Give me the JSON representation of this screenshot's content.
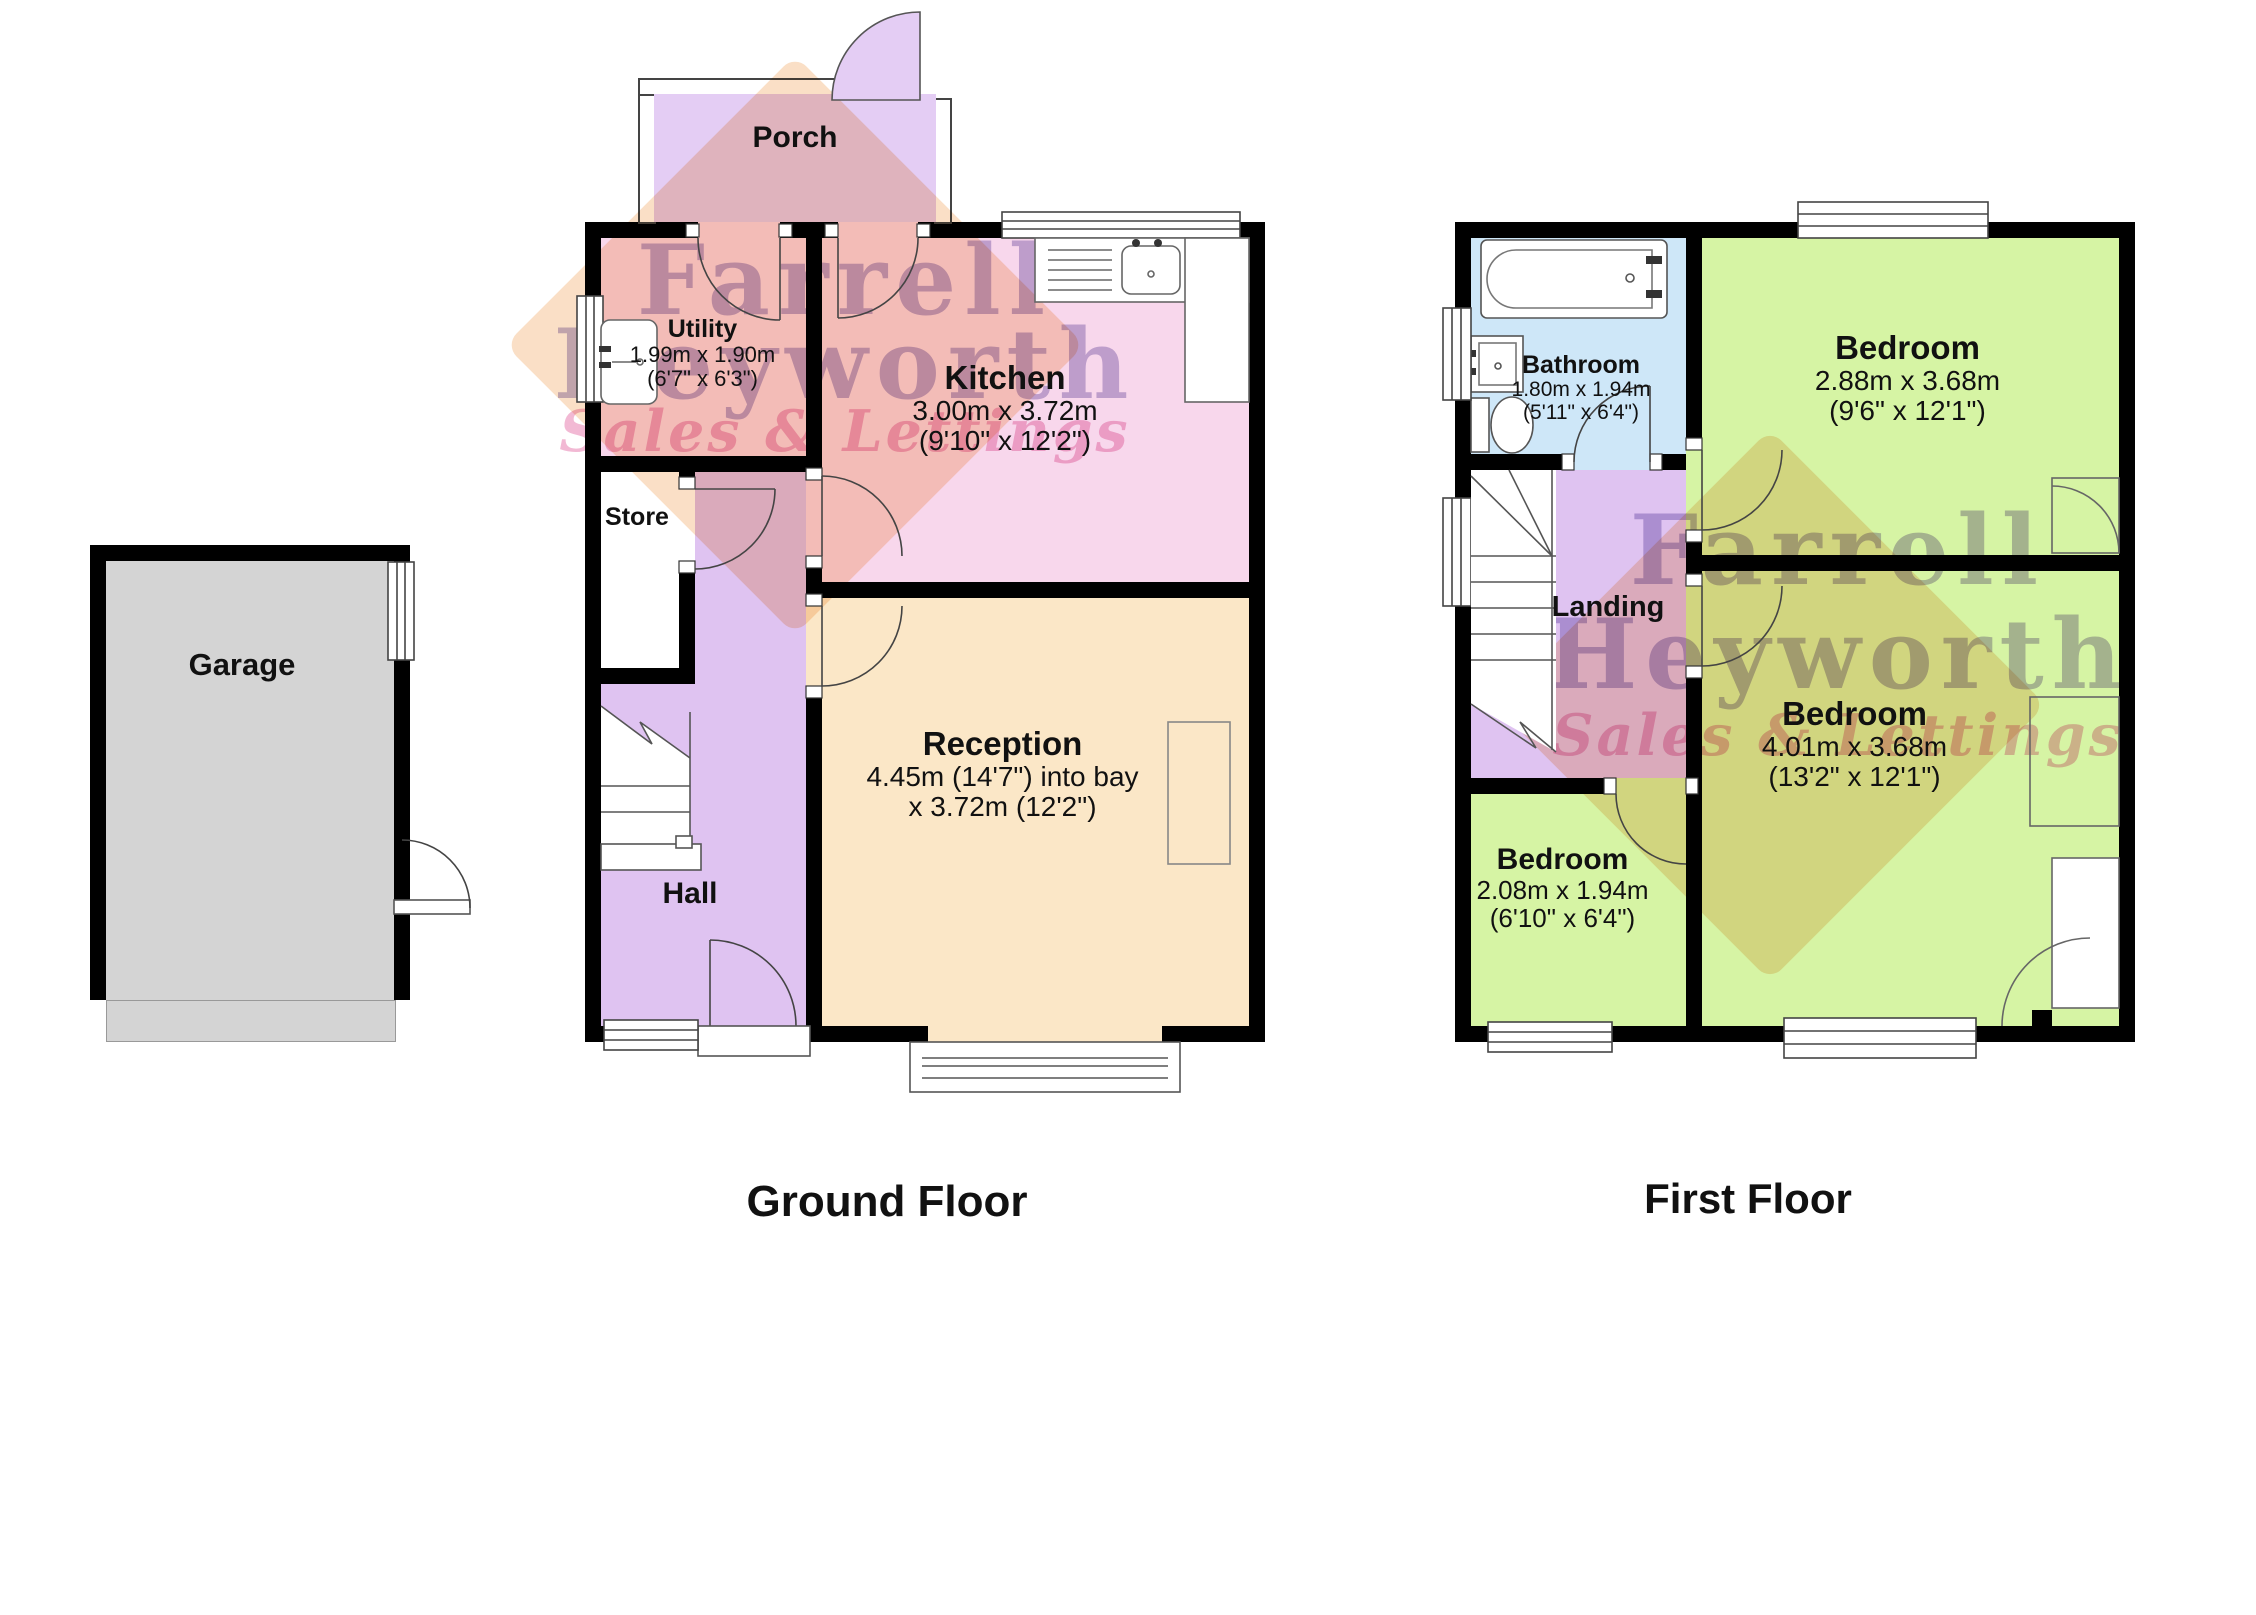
{
  "watermark": {
    "line1": "Farrell",
    "line2": "Heyworth",
    "line3": "Sales & Lettings"
  },
  "ground_floor": {
    "title": "Ground Floor",
    "porch": {
      "name": "Porch"
    },
    "utility": {
      "name": "Utility",
      "metric": "1.99m x 1.90m",
      "imperial": "(6'7\" x 6'3\")"
    },
    "kitchen": {
      "name": "Kitchen",
      "metric": "3.00m x 3.72m",
      "imperial": "(9'10\" x 12'2\")"
    },
    "store": {
      "name": "Store"
    },
    "hall": {
      "name": "Hall"
    },
    "reception": {
      "name": "Reception",
      "metric": "4.45m (14'7\") into bay",
      "imperial": "x 3.72m (12'2\")"
    },
    "garage": {
      "name": "Garage"
    }
  },
  "first_floor": {
    "title": "First Floor",
    "bathroom": {
      "name": "Bathroom",
      "metric": "1.80m x 1.94m",
      "imperial": "(5'11\" x 6'4\")"
    },
    "bedroom_front": {
      "name": "Bedroom",
      "metric": "2.88m x 3.68m",
      "imperial": "(9'6\" x 12'1\")"
    },
    "bedroom_rear": {
      "name": "Bedroom",
      "metric": "4.01m x 3.68m",
      "imperial": "(13'2\" x 12'1\")"
    },
    "bedroom_small": {
      "name": "Bedroom",
      "metric": "2.08m x 1.94m",
      "imperial": "(6'10\" x 6'4\")"
    },
    "landing": {
      "name": "Landing"
    }
  },
  "colors": {
    "wall": "#000000",
    "purple_room": "#dfc3f1",
    "porch_purple": "#e4cdf4",
    "pink_room": "#f8d7ec",
    "cream_room": "#fbe7c7",
    "green_room": "#d6f4a4",
    "blue_room": "#cee7f8",
    "grey_room": "#d4d4d4",
    "white_room": "#ffffff",
    "watermark_purple": "#8d7abc",
    "watermark_pink": "#e886b4",
    "watermark_orange": "#f6c596"
  }
}
